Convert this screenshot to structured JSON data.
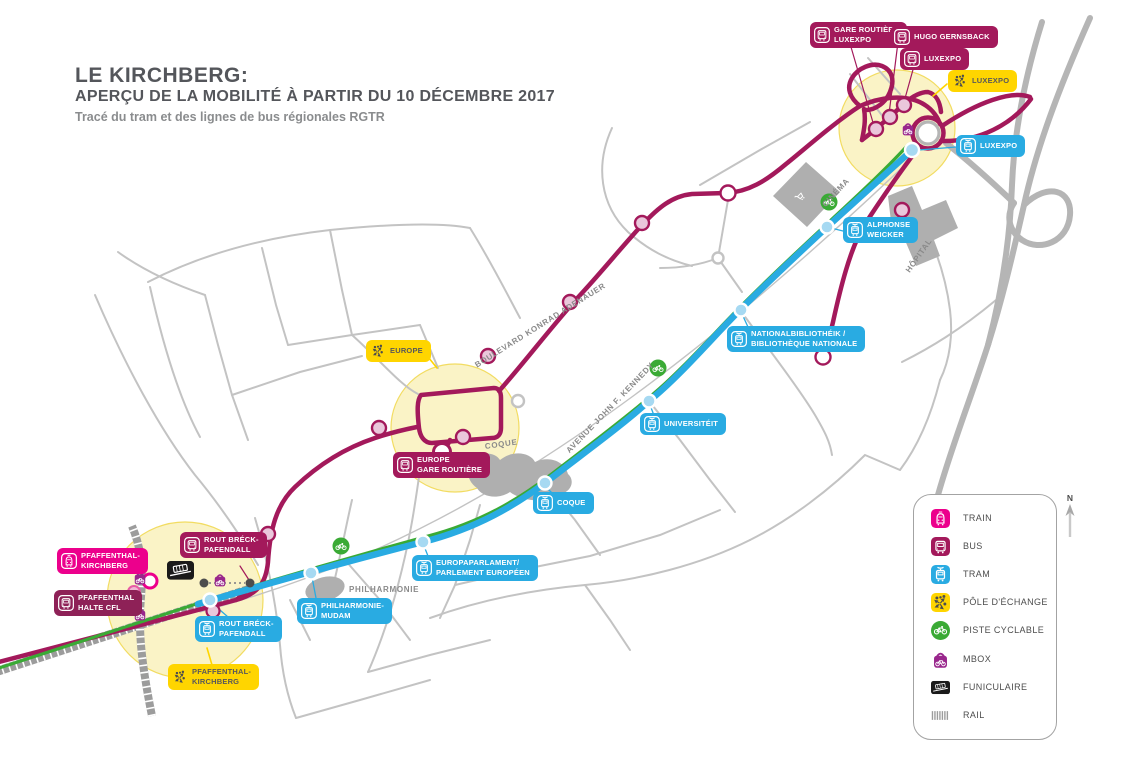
{
  "header": {
    "title": "LE KIRCHBERG:",
    "subtitle": "APERÇU DE LA MOBILITÉ À PARTIR DU 10 DÉCEMBRE 2017",
    "tagline": "Tracé du tram et des lignes de bus régionales RGTR"
  },
  "stations": {
    "gare_routiere_luxexpo": "GARE ROUTIÈRE\nLUXEXPO",
    "hugo_gernsback": "HUGO GERNSBACK",
    "luxexpo_bus": "LUXEXPO",
    "luxexpo_pole": "LUXEXPO",
    "luxexpo_tram": "LUXEXPO",
    "alphonse_weicker": "ALPHONSE\nWEICKER",
    "bibliotheque": "NATIONALBIBLIOTHÉIK /\nBIBLIOTHÈQUE NATIONALE",
    "universiteit": "UNIVERSITÉIT",
    "coque": "COQUE",
    "europaparlament": "EUROPAPARLAMENT/\nPARLEMENT EUROPÉEN",
    "philharmonie_mudam": "PHILHARMONIE-\nMUDAM",
    "rout_breck_tram": "ROUT BRÉCK-\nPAFENDALL",
    "rout_breck_bus": "ROUT BRÉCK-\nPAFENDALL",
    "pfaffenthal_kirchberg_train": "PFAFFENTHAL-\nKIRCHBERG",
    "pfaffenthal_halte_cfl": "PFAFFENTHAL\nHALTE CFL",
    "pfaffenthal_kirchberg_pole": "PFAFFENTHAL-\nKIRCHBERG",
    "europe_pole": "EUROPE",
    "europe_gare_routiere": "EUROPE\nGARE ROUTIÈRE"
  },
  "streets": {
    "adenauer": "BOULEVARD KONRAD ADENAUER",
    "kennedy": "AVENUE JOHN F. KENNEDY",
    "cinema": "CINÉMA",
    "hopital": "HÔPITAL",
    "coque": "COQUE",
    "philharmonie": "PHILHARMONIE"
  },
  "legend": {
    "items": [
      {
        "label": "TRAIN",
        "icon": "train-icon",
        "color": "#EC008C"
      },
      {
        "label": "BUS",
        "icon": "bus-icon",
        "color": "#A3195B"
      },
      {
        "label": "TRAM",
        "icon": "tram-icon",
        "color": "#29ABE2"
      },
      {
        "label": "PÔLE D'ÉCHANGE",
        "icon": "interchange-arrows-icon",
        "color": "#FFD500"
      },
      {
        "label": "PISTE CYCLABLE",
        "icon": "bicycle-icon",
        "color": "#3AAA35"
      },
      {
        "label": "MBOX",
        "icon": "bike-locker-icon",
        "color": "#99268C"
      },
      {
        "label": "FUNICULAIRE",
        "icon": "funicular-icon",
        "color": "#1A1A1A"
      },
      {
        "label": "RAIL",
        "icon": "rail-hatch-icon",
        "color": "#9C9C9C"
      }
    ]
  },
  "north": {
    "label": "N"
  }
}
